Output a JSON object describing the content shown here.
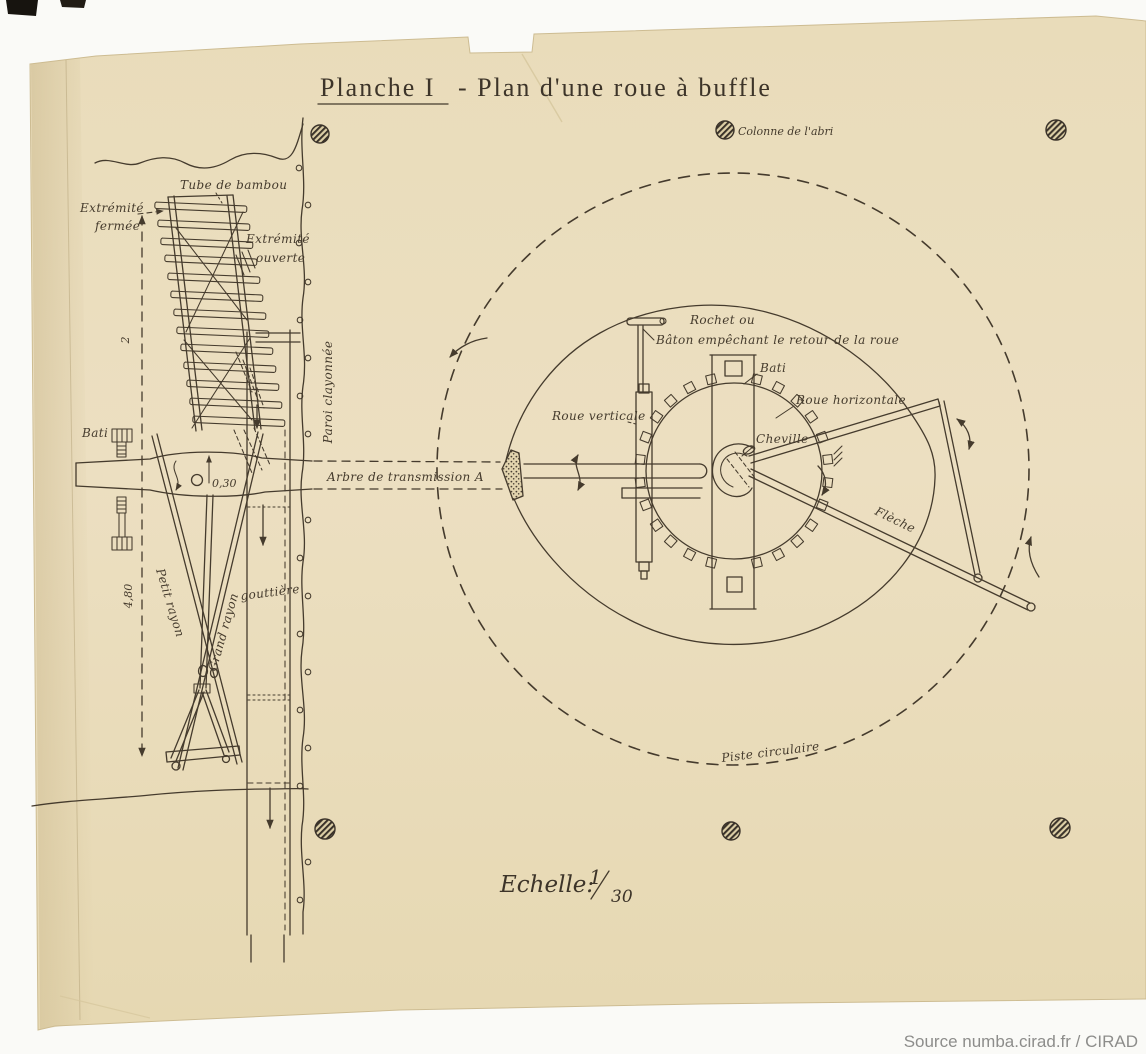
{
  "page": {
    "background": "#fafaf7",
    "attribution": "Source numba.cirad.fr / CIRAD"
  },
  "plate": {
    "title_part1": "Planche I",
    "title_part2": "- Plan d'une roue à buffle",
    "scale": {
      "label": "Echelle:",
      "numerator": "1",
      "denominator": "30"
    },
    "colors": {
      "paper": "#ebdfbf",
      "ink": "#453b2d",
      "binding_black": "#17140f",
      "attribution_text": "#8d8d8b"
    },
    "labels": {
      "colonne_abri": "Colonne de l'abri",
      "tube_bambou": "Tube de bambou",
      "extremite_fermee_l1": "Extrémité",
      "extremite_fermee_l2": "fermée",
      "extremite_ouverte_l1": "Extrémité",
      "extremite_ouverte_l2": "ouverte",
      "paroi_clayonnee": "Paroi clayonnée",
      "bati_left": "Bati",
      "diametre": "0,30",
      "arbre": "Arbre de transmission A",
      "dim_2": "2",
      "dim_480": "4,80",
      "petit_rayon": "Petit rayon",
      "grand_rayon": "Grand rayon",
      "gouttiere": "gouttière",
      "rochet_l1": "Rochet ou",
      "rochet_l2": "Bâton empêchant le retour de la roue",
      "bati_right": "Bati",
      "roue_verticale": "Roue verticale",
      "roue_horizontale": "Roue horizontale",
      "cheville": "Cheville",
      "fleche": "Flèche",
      "piste_circulaire": "Piste circulaire"
    }
  }
}
